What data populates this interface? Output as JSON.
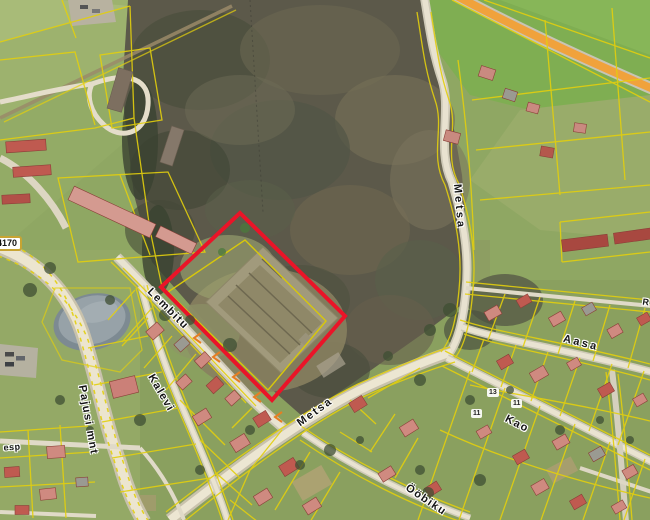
{
  "map": {
    "description": "Aerial orthophoto cadastral map with parcel boundaries and a selected parcel outlined in red",
    "road_badge": {
      "number": "4170"
    },
    "street_labels": [
      {
        "name": "pajusi-mnt",
        "text": "Pajusi mnt"
      },
      {
        "name": "lembitu",
        "text": "Lembitu"
      },
      {
        "name": "kalevi",
        "text": "Kalevi"
      },
      {
        "name": "metsa-north",
        "text": "Metsa"
      },
      {
        "name": "metsa-main",
        "text": "Metsa"
      },
      {
        "name": "aasa",
        "text": "Aasa"
      },
      {
        "name": "kao",
        "text": "Kao"
      },
      {
        "name": "oobiku",
        "text": "Ööbiku"
      },
      {
        "name": "partial-left",
        "text": "esp"
      },
      {
        "name": "partial-right",
        "text": "R"
      }
    ],
    "parcel_numbers": [
      {
        "text": "13"
      },
      {
        "text": "11"
      },
      {
        "text": "11"
      }
    ],
    "colors": {
      "selection_red": "#ea1428",
      "cadastral_yellow": "#e3cf0e",
      "road_highlight_orange": "#f0a23c",
      "water": "#97a2a8",
      "forest": "#5c594a",
      "field_green": "#8fa763",
      "boundary_marker_orange": "#e67e22"
    }
  }
}
